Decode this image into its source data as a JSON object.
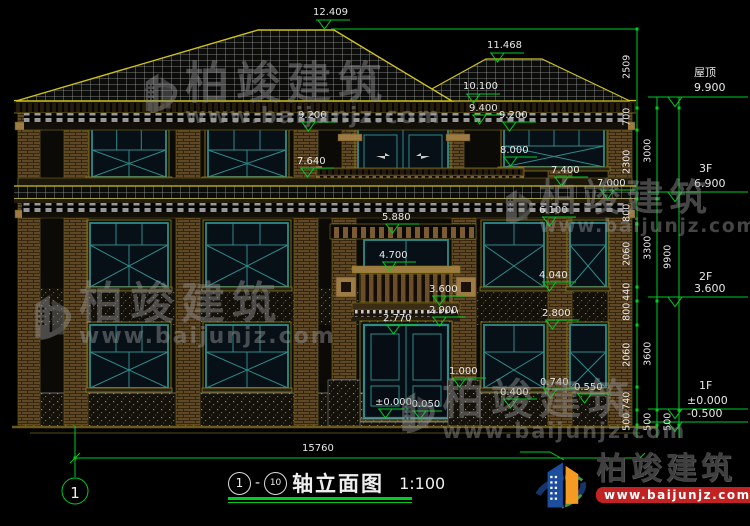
{
  "levels": {
    "ridge_main": "12.409",
    "ridge_secondary": "11.468",
    "eave_top": "10.100",
    "eave_bottom": "9.400",
    "soffit_left": "9.200",
    "soffit_right": "9.200",
    "window_top_3f": "8.000",
    "balcony_rail_3f": "7.640",
    "skirt_roof_top": "7.400",
    "skirt_eave": "7.000",
    "window_top_2f": "6.100",
    "band_2f": "5.880",
    "canopy_top": "4.700",
    "window_sill_2f": "4.040",
    "floor_2f": "3.600",
    "door_head_trim": "2.900",
    "window_top_1f": "2.800",
    "door_top": "2.770",
    "porch_base": "1.000",
    "window_sill_1f": "0.740",
    "plinth_right": "0.550",
    "plinth_ledge": "0.400",
    "ground_zero": "±0.000",
    "entry_step": "-0.050"
  },
  "right_axis": {
    "roof_label": "屋顶",
    "roof_level": "9.900",
    "f3_label": "3F",
    "f3_level": "6.900",
    "f2_label": "2F",
    "f2_level": "3.600",
    "f1_label": "1F",
    "f1_level": "±0.000",
    "basement_level": "-0.500"
  },
  "dims": {
    "col1": [
      "2509",
      "700",
      "2300",
      "800",
      "2060",
      "440",
      "800",
      "2060",
      "740",
      "500"
    ],
    "col2": [
      "3000",
      "3300",
      "3600",
      "500"
    ],
    "col3": [
      "9900",
      "500"
    ],
    "total_width": "15760"
  },
  "axis_bubble": "1",
  "title_block": {
    "axis_start": "1",
    "axis_end": "10",
    "separator": "-",
    "name": "轴立面图",
    "scale": "1:100"
  },
  "watermark": {
    "brand": "柏竣建筑",
    "url": "www.baijunjz.com"
  },
  "logo": {
    "brand": "柏竣建筑",
    "url": "www.baijunjz.com"
  },
  "colors": {
    "dimension_green": "#00cc22",
    "outline_yellow": "#cfc31c",
    "window_teal": "#2f8a8a",
    "logo_blue": "#1d4e9e",
    "logo_orange": "#f59a23",
    "banner_red": "#c32222"
  }
}
